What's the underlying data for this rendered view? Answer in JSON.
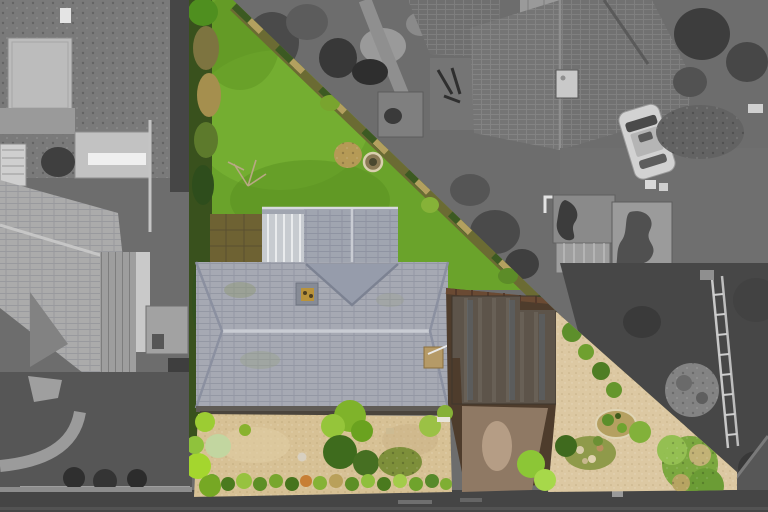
{
  "scene": {
    "type": "aerial-drone-photograph",
    "description": "Top-down aerial photo of a triangular residential plot highlighted in colour; all neighbouring land is desaturated grayscale. A bungalow with a grey tiled roof sits mid-plot with a bright green rear lawn above it, gravel front gardens with shrubs below it, a dark brown flat garage roof and driveway leading to the road at the bottom.",
    "highlight": {
      "style": "colour-on-grayscale",
      "boundary_vertices_px": [
        [
          189,
          0
        ],
        [
          233,
          0
        ],
        [
          560,
          315
        ],
        [
          737,
          472
        ],
        [
          737,
          490
        ],
        [
          520,
          494
        ],
        [
          189,
          497
        ]
      ]
    },
    "regions": {
      "rear_lawn": "bright green triangular rear lawn",
      "main_house_roof": "grey tiled hipped bungalow roof with two chimneys and a metal-panel rear section",
      "front_garden": "tan gravel garden with clipped green shrubs and a planted hedge row",
      "garage_roof": "dark brown flat garage roof beside the house",
      "driveway": "brown driveway running to the road",
      "boundary_fence": "pale timber fence line along the diagonal boundary with a mixed hedge",
      "left_neighbour": "grayscale neighbouring house, greenhouse and garden to the west",
      "top_neighbour": "grayscale neighbouring garden with sheds and pond-stained flat roofs",
      "right_neighbour": "grayscale neighbouring house with large dark tiled roof, parked car and rockery",
      "road": "grey asphalt road along the bottom edge"
    },
    "palette": {
      "lawn_green": "#6aa32b",
      "lawn_light": "#7cb836",
      "lawn_dark": "#578e1f",
      "gravel_tan": "#d7c195",
      "gravel_warm": "#dcc8a2",
      "roof_grey": "#a6a9b3",
      "roof_ridge": "#c9ccd3",
      "metal_roof": "#c7cbd0",
      "patio_moss": "#6e6233",
      "garage_brown": "#5d544a",
      "ground_brown": "#4e3c2c",
      "driveway_taupe": "#8f7964",
      "stain_light": "#b59d85",
      "fence_tan": "#d8c57e",
      "hedge_olive": "#7d7440",
      "hedge_dark": "#3a5a22",
      "shrub_chartreuse": "#9ccc33",
      "road_grey": "#454545",
      "neutral_ground": "#6d6d6d",
      "dark_garden": "#474747",
      "neighbour_roof_dark": "#757575",
      "neighbour_roof_light": "#ababab",
      "car_body": "#d2d2d2"
    }
  }
}
